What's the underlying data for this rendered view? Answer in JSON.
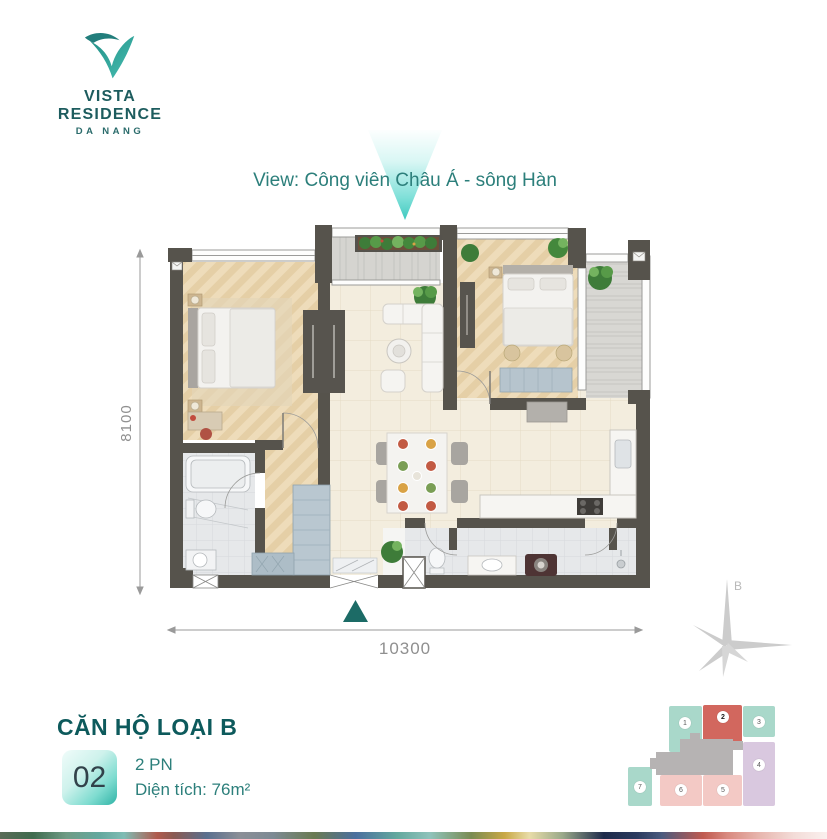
{
  "brand": {
    "name": "VISTA RESIDENCE",
    "city": "DA NANG"
  },
  "view": {
    "label": "View: Công viên Châu Á - sông Hàn"
  },
  "plan": {
    "dim_height": "8100",
    "dim_width": "10300"
  },
  "compass": {
    "label": "B"
  },
  "unit": {
    "title": "CĂN HỘ LOẠI B",
    "number": "02",
    "bedrooms": "2 PN",
    "area": "Diện tích: 76m²"
  },
  "keyplan": {
    "highlighted_unit": "2",
    "units": [
      {
        "number": "1",
        "color": "#a9d8ca"
      },
      {
        "number": "2",
        "color": "#d2675e"
      },
      {
        "number": "3",
        "color": "#a9d8ca"
      },
      {
        "number": "4",
        "color": "#d9c8df"
      },
      {
        "number": "5",
        "color": "#f3c9c5"
      },
      {
        "number": "6",
        "color": "#f3c9c5"
      },
      {
        "number": "7",
        "color": "#a9d8ca"
      }
    ]
  },
  "colors": {
    "teal_accent": "#2c7f7b",
    "heading_teal": "#0d5a5c",
    "wall": "#56534c",
    "entrance_triangle": "#1c6b66",
    "view_arrow": "#3ec9bf",
    "keyplan_highlight": "#d2675e",
    "keyplan_core": "#b6b3b3",
    "dimension_gray": "#8f8f8f"
  }
}
